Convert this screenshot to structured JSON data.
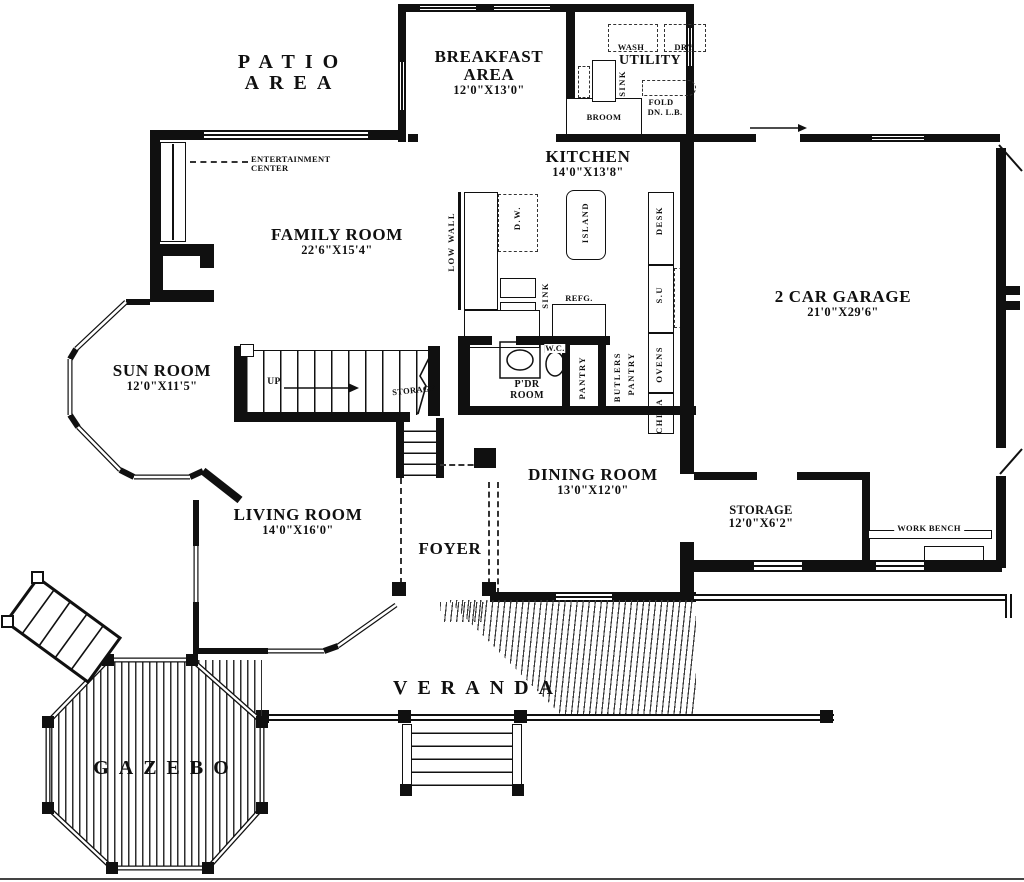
{
  "areas": {
    "patio": {
      "line1": "PATIO",
      "line2": "AREA"
    },
    "veranda": {
      "name": "VERANDA"
    },
    "gazebo": {
      "name": "GAZEBO"
    }
  },
  "rooms": {
    "breakfast": {
      "line1": "BREAKFAST",
      "line2": "AREA",
      "dims": "12'0\"X13'0\""
    },
    "utility": {
      "name": "UTILITY"
    },
    "kitchen": {
      "name": "KITCHEN",
      "dims": "14'0\"X13'8\""
    },
    "family": {
      "name": "FAMILY ROOM",
      "dims": "22'6\"X15'4\""
    },
    "sun": {
      "name": "SUN ROOM",
      "dims": "12'0\"X11'5\""
    },
    "living": {
      "name": "LIVING ROOM",
      "dims": "14'0\"X16'0\""
    },
    "dining": {
      "name": "DINING ROOM",
      "dims": "13'0\"X12'0\""
    },
    "foyer": {
      "name": "FOYER"
    },
    "garage": {
      "name": "2 CAR GARAGE",
      "dims": "21'0\"X29'6\""
    },
    "storage": {
      "name": "STORAGE",
      "dims": "12'0\"X6'2\""
    },
    "powder": {
      "line1": "P'DR",
      "line2": "ROOM"
    }
  },
  "labels": {
    "entertainment1": "ENTERTAINMENT",
    "entertainment2": "CENTER",
    "wash": "WASH",
    "dry": "DRY",
    "sink_utility": "SINK",
    "broom": "BROOM",
    "fold1": "FOLD",
    "fold2": "DN. L.B.",
    "low_wall": "LOW WALL",
    "dw": "D.W.",
    "sink": "SINK",
    "island": "ISLAND",
    "refg": "REFG.",
    "desk": "DESK",
    "su": "S.U",
    "ovens": "OVENS",
    "china": "CHINA",
    "butlers1": "BUTLERS",
    "butlers2": "PANTRY",
    "pantry": "PANTRY",
    "wc": "W.C.",
    "up": "UP",
    "stair_storage": "STORAGE",
    "work_bench": "WORK BENCH"
  },
  "colors": {
    "ink": "#101010",
    "paper": "#ffffff"
  }
}
